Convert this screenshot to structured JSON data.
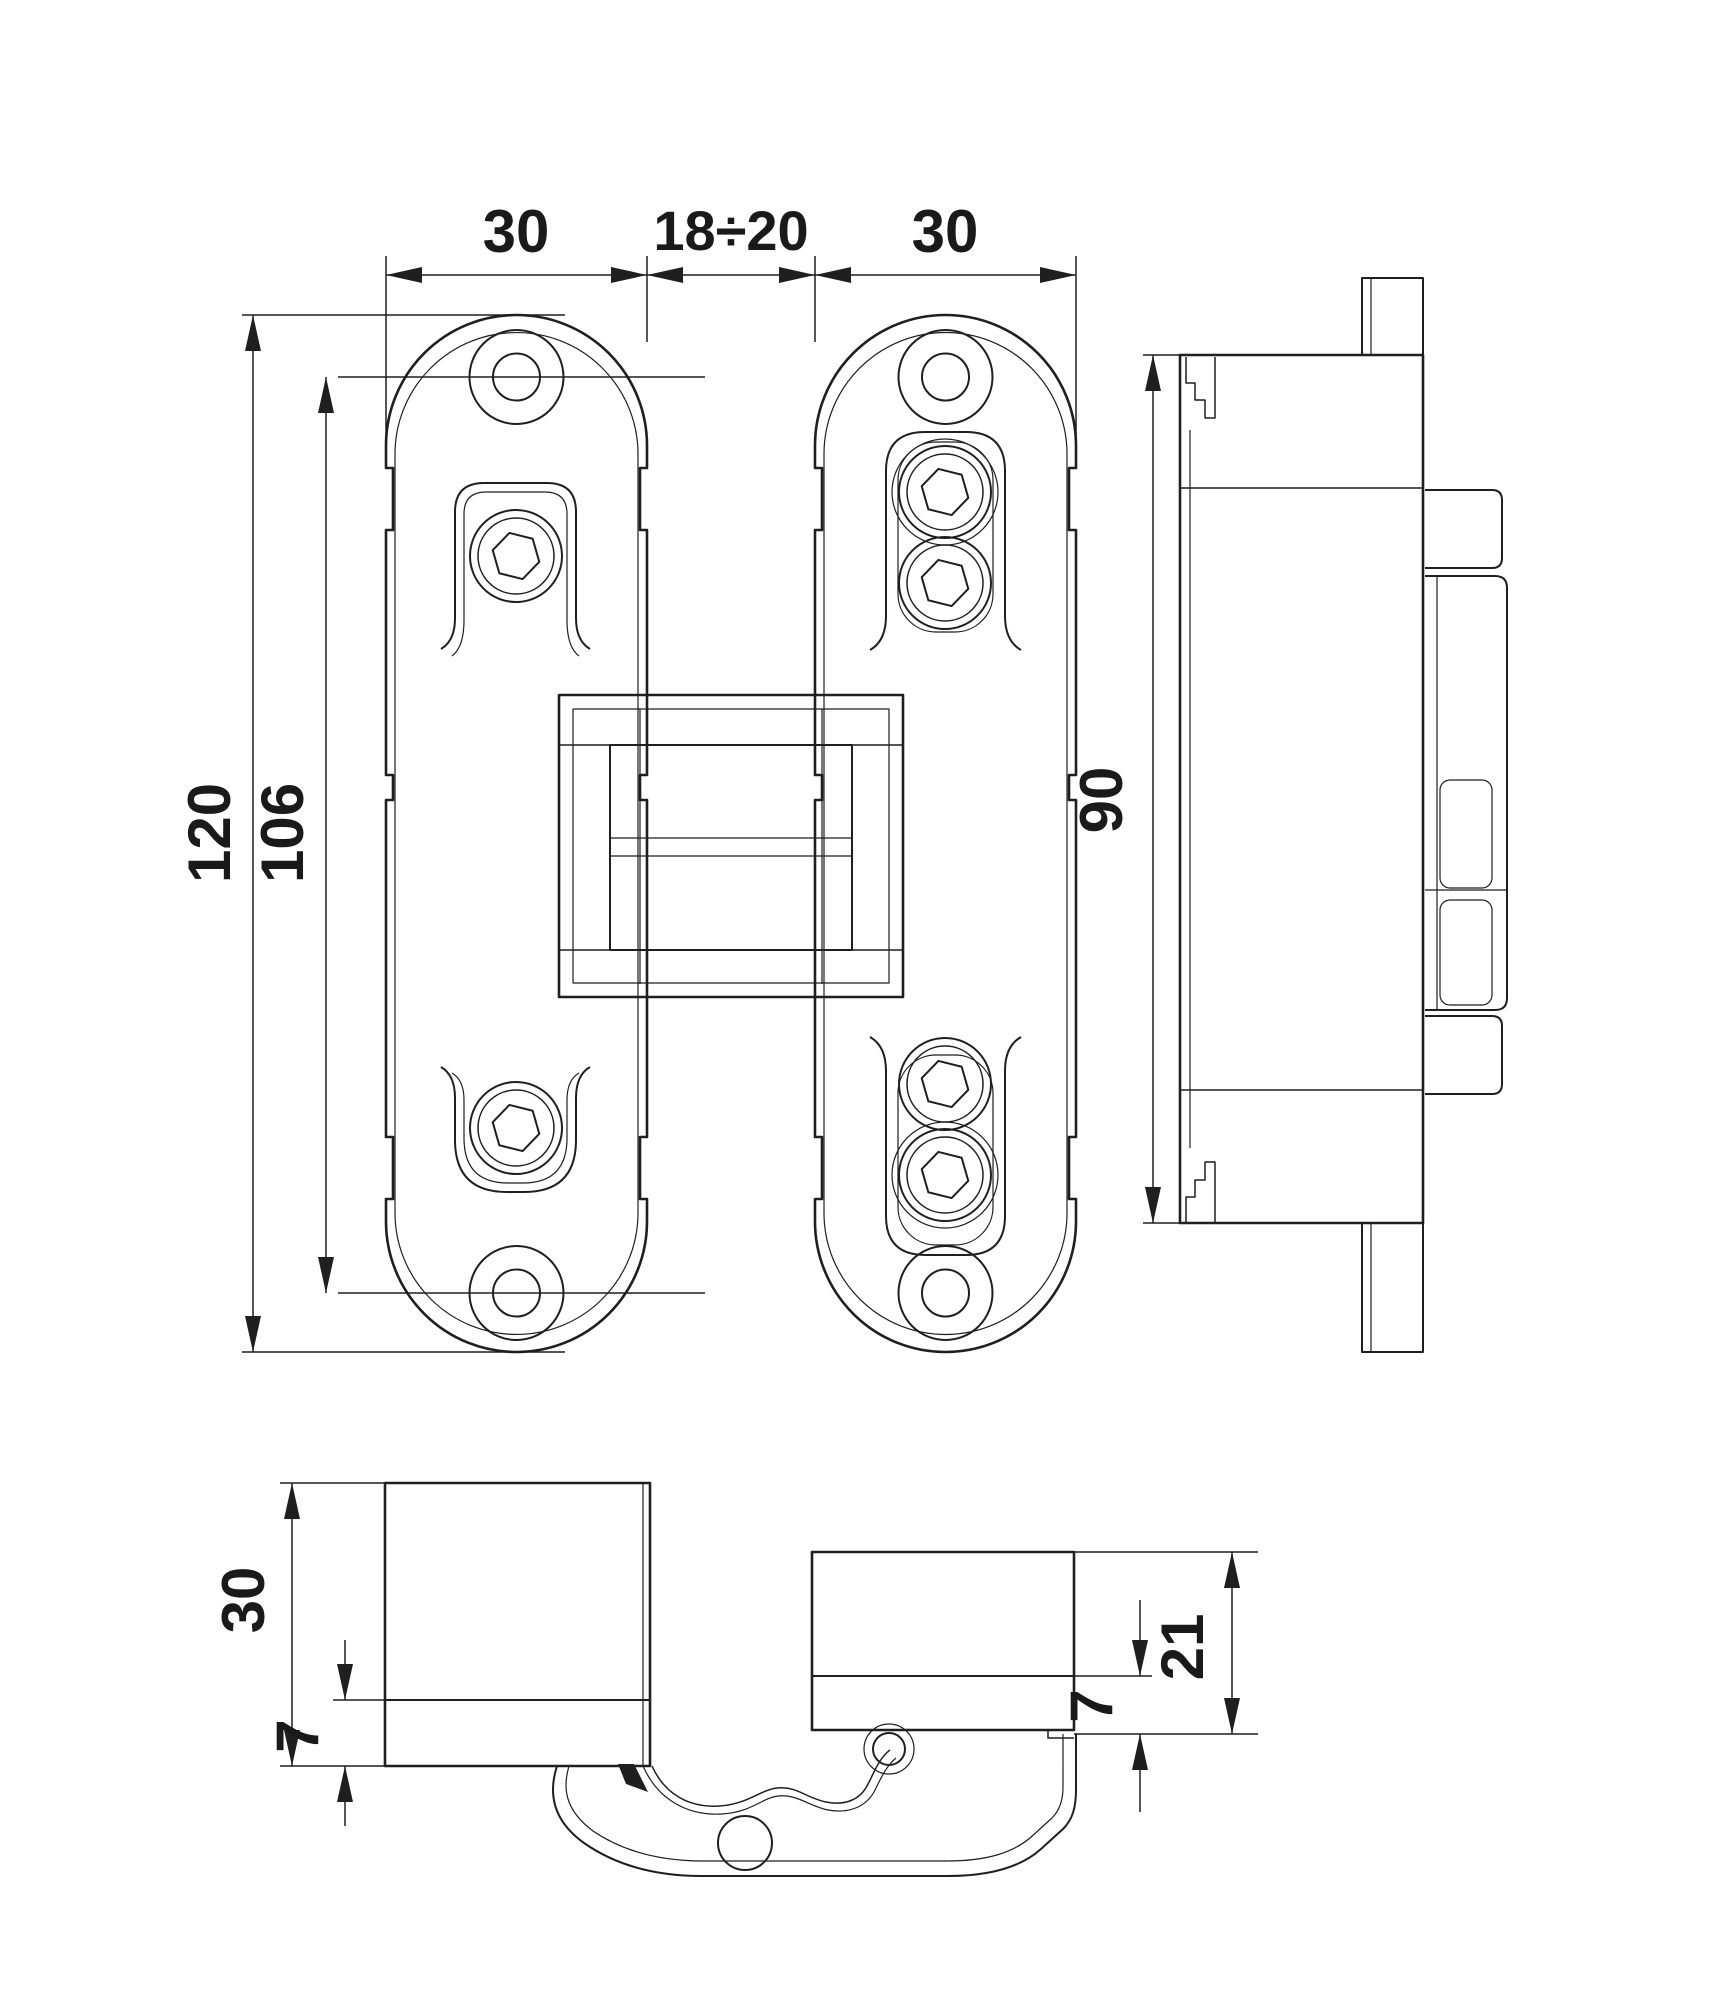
{
  "drawing": {
    "type": "technical-drawing",
    "subject": "concealed-invisible-hinge",
    "views": [
      "front",
      "side",
      "section-door-leaf",
      "section-frame"
    ]
  },
  "dims": {
    "top": [
      "30",
      "18÷20",
      "30"
    ],
    "front_left": [
      "120",
      "106"
    ],
    "side": [
      "90"
    ],
    "bottom_door": {
      "total": "30",
      "recess": "7"
    },
    "bottom_frame": {
      "total": "21",
      "recess": "7"
    }
  },
  "colors": {
    "line": "#1f1f1f",
    "text": "#1a1a1a",
    "background": "#ffffff"
  }
}
